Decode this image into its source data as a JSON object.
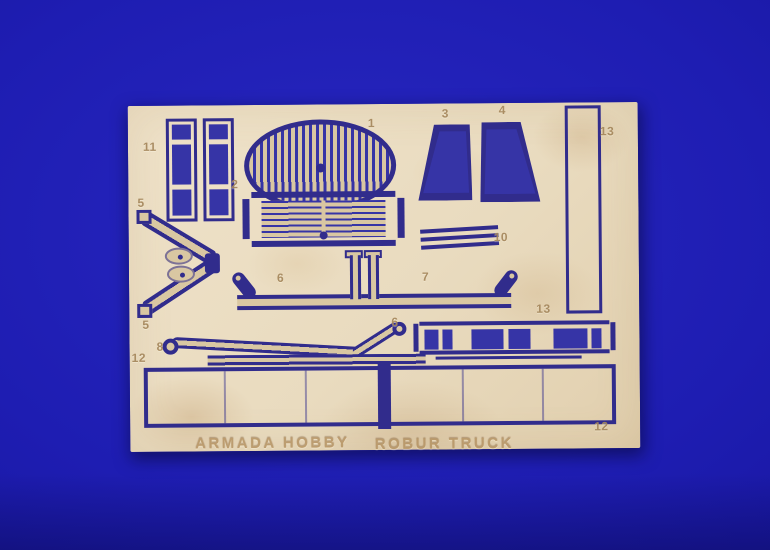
{
  "scene": {
    "type": "photograph",
    "subject": "photo-etched brass detail fret for a model truck kit, lying on blue cloth",
    "colors": {
      "bg": "#1e1db2",
      "bgdeep": "#131190",
      "fret": "#e9dbbf",
      "etch": "#312c8c",
      "hole": "#3634a6",
      "slat": "#d9c7a2",
      "stain": "#c9a878",
      "label": "#a5875c",
      "emboss": "#b3905f"
    },
    "brand_text": "ARMADA HOBBY",
    "product_text": "ROBUR TRUCK",
    "part_labels": [
      {
        "text": "11",
        "x": 15,
        "y": 34
      },
      {
        "text": "5",
        "x": 9,
        "y": 90
      },
      {
        "text": "2",
        "x": 103,
        "y": 72
      },
      {
        "text": "1",
        "x": 240,
        "y": 12
      },
      {
        "text": "3",
        "x": 314,
        "y": 3
      },
      {
        "text": "4",
        "x": 371,
        "y": 0
      },
      {
        "text": "13",
        "x": 472,
        "y": 22
      },
      {
        "text": "10",
        "x": 365,
        "y": 127
      },
      {
        "text": "6",
        "x": 148,
        "y": 166
      },
      {
        "text": "7",
        "x": 293,
        "y": 166
      },
      {
        "text": "6",
        "x": 262,
        "y": 211
      },
      {
        "text": "5",
        "x": 13,
        "y": 212
      },
      {
        "text": "8",
        "x": 27,
        "y": 234
      },
      {
        "text": "12",
        "x": 2,
        "y": 245
      },
      {
        "text": "13",
        "x": 407,
        "y": 199
      },
      {
        "text": "12",
        "x": 464,
        "y": 317
      }
    ]
  }
}
